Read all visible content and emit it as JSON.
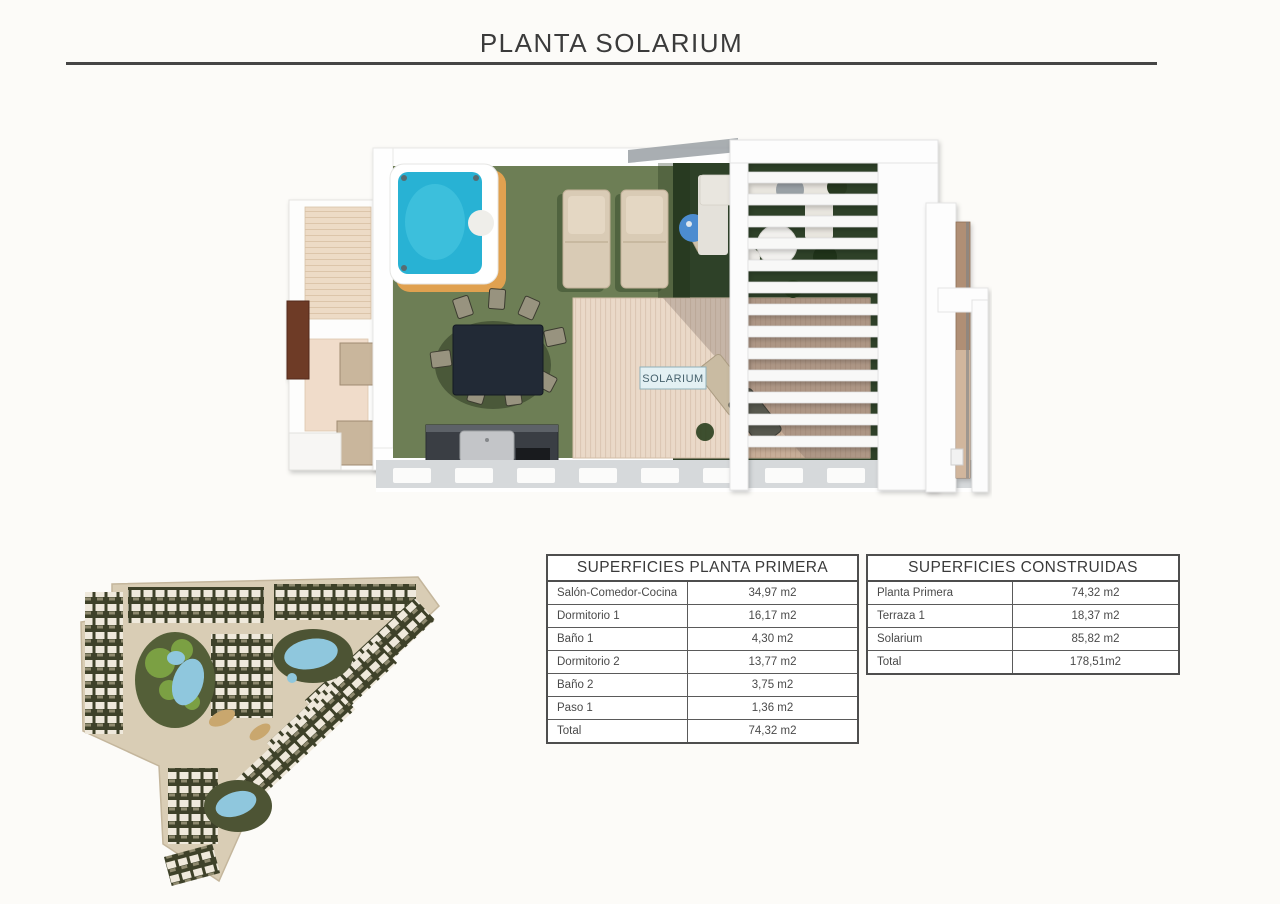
{
  "page": {
    "title": "PLANTA SOLARIUM",
    "background": "#fcfbf8",
    "rule_color": "#454545"
  },
  "floor_plan": {
    "room_label": "SOLARIUM",
    "colors": {
      "grass": "#6d7e55",
      "shaded_lawn": "#2e4128",
      "deck_wood": "#ead9c8",
      "jacuzzi_water": "#28b2d4",
      "jacuzzi_trim": "#e0a150",
      "pergola_white": "#fbfbfa",
      "kitchen_dark": "#3a3e44"
    },
    "features": [
      "jacuzzi",
      "sun-loungers",
      "parasol",
      "lounge-sofa-set",
      "dining-set",
      "outdoor-kitchen",
      "pergola",
      "wood-deck",
      "side-terrace",
      "walkway"
    ]
  },
  "site_plan": {
    "description": "residential development masterplan with townhouse rows, pools and gardens",
    "colors": {
      "ground": "#d9cdb5",
      "blocks": "#3e4129",
      "pool": "#8fc7dd",
      "park_green": "#7ba043"
    }
  },
  "tables": {
    "planta_primera": {
      "header": "SUPERFICIES PLANTA PRIMERA",
      "rows": [
        {
          "label": "Salón-Comedor-Cocina",
          "value": "34,97 m2"
        },
        {
          "label": "Dormitorio 1",
          "value": "16,17 m2"
        },
        {
          "label": "Baño 1",
          "value": "4,30 m2"
        },
        {
          "label": "Dormitorio 2",
          "value": "13,77 m2"
        },
        {
          "label": "Baño 2",
          "value": "3,75 m2"
        },
        {
          "label": "Paso 1",
          "value": "1,36 m2"
        },
        {
          "label": "Total",
          "value": "74,32 m2"
        }
      ]
    },
    "construidas": {
      "header": "SUPERFICIES CONSTRUIDAS",
      "rows": [
        {
          "label": "Planta Primera",
          "value": "74,32 m2"
        },
        {
          "label": "Terraza 1",
          "value": "18,37 m2"
        },
        {
          "label": "Solarium",
          "value": "85,82 m2"
        },
        {
          "label": "Total",
          "value": "178,51m2"
        }
      ]
    }
  }
}
